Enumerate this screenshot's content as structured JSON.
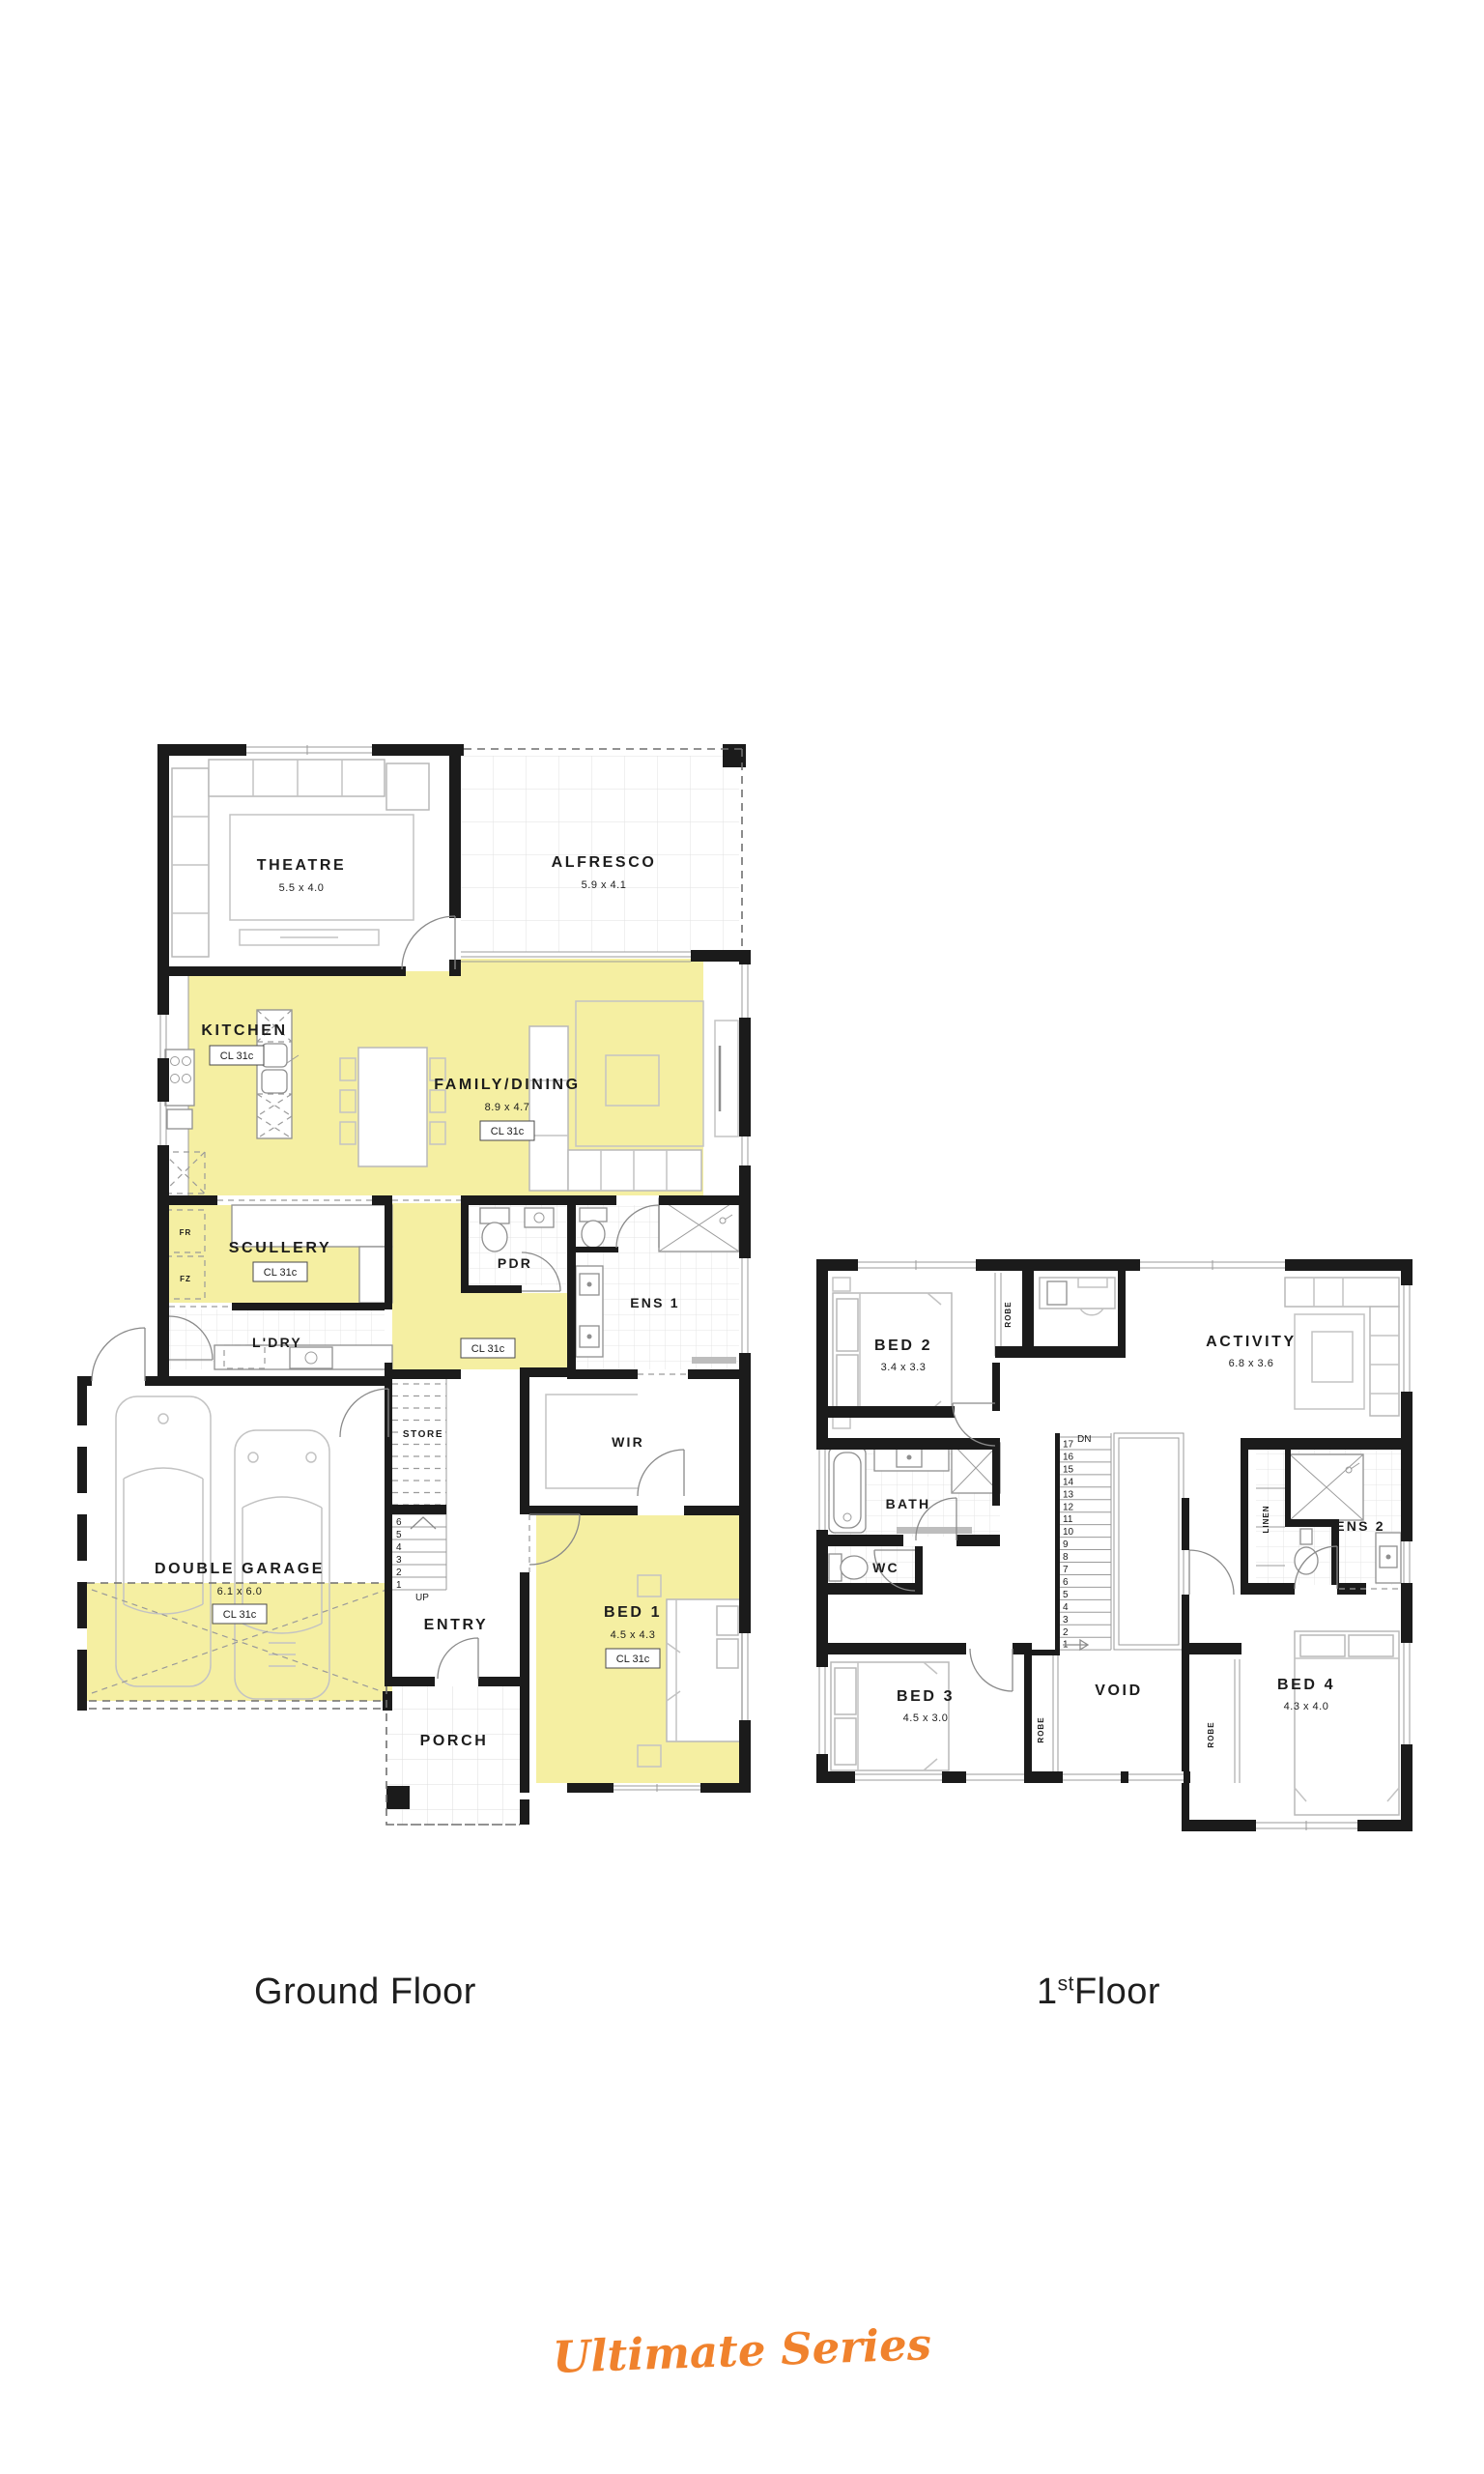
{
  "colors": {
    "highlight_yellow": "#f5efa2",
    "brand_orange": "#f0822d",
    "wall_black": "#1b1b1b"
  },
  "brand": {
    "text": "Ultimate Series"
  },
  "captions": {
    "ground": "Ground Floor",
    "first_number": "1",
    "first_sup": "st",
    "first_rest": "Floor"
  },
  "ground_floor": {
    "rooms": {
      "theatre": {
        "name": "THEATRE",
        "dims": "5.5 x 4.0"
      },
      "alfresco": {
        "name": "ALFRESCO",
        "dims": "5.9 x 4.1"
      },
      "kitchen": {
        "name": "KITCHEN",
        "tag": "CL 31c"
      },
      "family": {
        "name": "FAMILY/DINING",
        "dims": "8.9 x 4.7",
        "tag": "CL 31c"
      },
      "scullery": {
        "name": "SCULLERY",
        "tag": "CL 31c"
      },
      "fridge": "FR",
      "freezer": "FZ",
      "laundry": {
        "name": "L'DRY"
      },
      "pdr": {
        "name": "PDR"
      },
      "hall": {
        "tag": "CL 31c"
      },
      "ens1": {
        "name": "ENS 1"
      },
      "store": {
        "name": "STORE"
      },
      "garage": {
        "name": "DOUBLE GARAGE",
        "dims": "6.1 x 6.0",
        "tag": "CL 31c"
      },
      "entry": {
        "name": "ENTRY"
      },
      "porch": {
        "name": "PORCH"
      },
      "wir": {
        "name": "WIR"
      },
      "bed1": {
        "name": "BED 1",
        "dims": "4.5 x 4.3",
        "tag": "CL 31c"
      },
      "up": "UP"
    },
    "stairs": {
      "numbers": [
        "6",
        "5",
        "4",
        "3",
        "2",
        "1"
      ]
    }
  },
  "first_floor": {
    "rooms": {
      "bed2": {
        "name": "BED 2",
        "dims": "3.4 x 3.3"
      },
      "robe2": "ROBE",
      "activity": {
        "name": "ACTIVITY",
        "dims": "6.8 x 3.6"
      },
      "bath": {
        "name": "BATH"
      },
      "wc": {
        "name": "WC"
      },
      "bed3": {
        "name": "BED 3",
        "dims": "4.5 x 3.0"
      },
      "robe3": "ROBE",
      "void": "VOID",
      "linen": "LINEN",
      "ens2": {
        "name": "ENS 2"
      },
      "bed4": {
        "name": "BED 4",
        "dims": "4.3 x 4.0"
      },
      "robe4": "ROBE",
      "dn": "DN"
    },
    "stairs": {
      "numbers": [
        "17",
        "16",
        "15",
        "14",
        "13",
        "12",
        "11",
        "10",
        "9",
        "8",
        "7",
        "6",
        "5",
        "4",
        "3",
        "2",
        "1"
      ]
    }
  }
}
